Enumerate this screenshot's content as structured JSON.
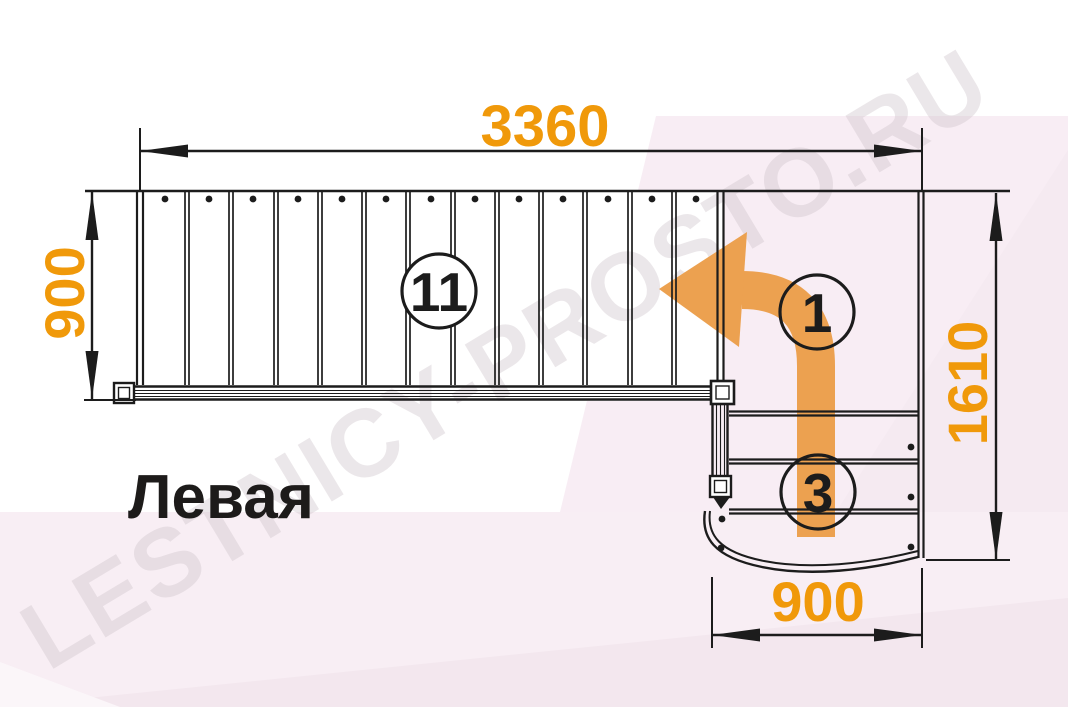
{
  "watermark_text": "LESTNICY-PROSTO.RU",
  "variant_label": "Левая",
  "dimensions": {
    "top_width": "3360",
    "flight_width": "900",
    "right_height": "1610",
    "bottom_width": "900"
  },
  "step_counts": {
    "main_flight": "11",
    "turn_arrow": "1",
    "lower_flight": "3"
  },
  "colors": {
    "dimension_text": "#F0990A",
    "arrow_fill": "#ECA150",
    "line": "#1C1C1C",
    "background_pink": "#F8EDF4",
    "background_pink_dark": "#F3E7EE",
    "watermark": "#CFC5CB"
  }
}
